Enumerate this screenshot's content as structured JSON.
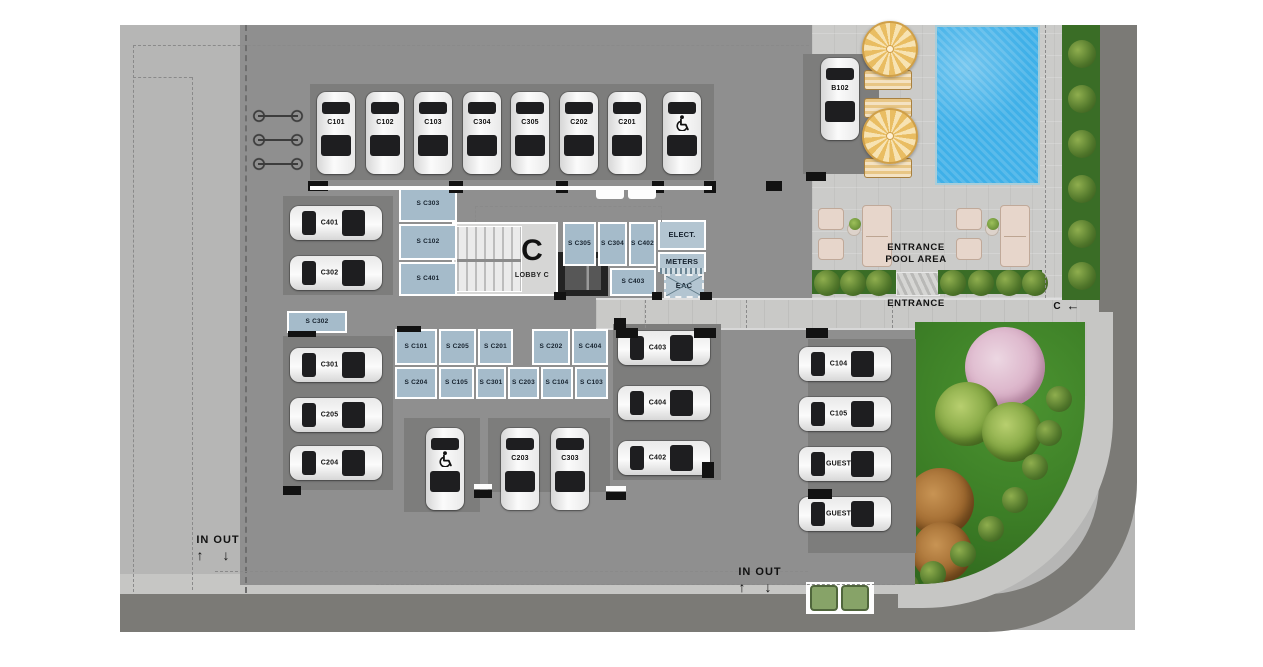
{
  "meta": {
    "type": "parking-site-plan",
    "building_letter": "C"
  },
  "colors": {
    "apron": "#b6b6b5",
    "garage_slab": "#8f8f8f",
    "parking_zone": "#7d7d7c",
    "storage_room": "#a5bbca",
    "pool_water": "#3fb0e8",
    "lawn": "#3c7e26",
    "road": "#7b7a76",
    "sidewalk": "#c6c6c4",
    "umbrella": "#e9bd62",
    "hedge": "#3a6d26"
  },
  "lobby": {
    "letter": "C",
    "label": "LOBBY C"
  },
  "zones": [
    {
      "x": 310,
      "y": 84,
      "w": 350,
      "h": 96
    },
    {
      "x": 659,
      "y": 84,
      "w": 55,
      "h": 96
    },
    {
      "x": 283,
      "y": 196,
      "w": 110,
      "h": 99
    },
    {
      "x": 283,
      "y": 336,
      "w": 110,
      "h": 154
    },
    {
      "x": 404,
      "y": 418,
      "w": 76,
      "h": 94
    },
    {
      "x": 488,
      "y": 418,
      "w": 122,
      "h": 74
    },
    {
      "x": 613,
      "y": 324,
      "w": 108,
      "h": 156
    },
    {
      "x": 803,
      "y": 54,
      "w": 76,
      "h": 120
    },
    {
      "x": 808,
      "y": 339,
      "w": 108,
      "h": 214
    }
  ],
  "cars": [
    {
      "label": "C101",
      "x": 317,
      "y": 92,
      "o": "v"
    },
    {
      "label": "C102",
      "x": 366,
      "y": 92,
      "o": "v"
    },
    {
      "label": "C103",
      "x": 414,
      "y": 92,
      "o": "v"
    },
    {
      "label": "C304",
      "x": 463,
      "y": 92,
      "o": "v"
    },
    {
      "label": "C305",
      "x": 511,
      "y": 92,
      "o": "v"
    },
    {
      "label": "C202",
      "x": 560,
      "y": 92,
      "o": "v"
    },
    {
      "label": "C201",
      "x": 608,
      "y": 92,
      "o": "v"
    },
    {
      "label": "",
      "x": 663,
      "y": 92,
      "o": "v",
      "hc": true
    },
    {
      "label": "C401",
      "x": 290,
      "y": 206,
      "o": "h"
    },
    {
      "label": "C302",
      "x": 290,
      "y": 256,
      "o": "h"
    },
    {
      "label": "C301",
      "x": 290,
      "y": 348,
      "o": "h"
    },
    {
      "label": "C205",
      "x": 290,
      "y": 398,
      "o": "h"
    },
    {
      "label": "C204",
      "x": 290,
      "y": 446,
      "o": "h"
    },
    {
      "label": "",
      "x": 426,
      "y": 428,
      "o": "v",
      "hc": true
    },
    {
      "label": "C203",
      "x": 501,
      "y": 428,
      "o": "v"
    },
    {
      "label": "C303",
      "x": 551,
      "y": 428,
      "o": "v"
    },
    {
      "label": "C403",
      "x": 618,
      "y": 331,
      "o": "h"
    },
    {
      "label": "C404",
      "x": 618,
      "y": 386,
      "o": "h"
    },
    {
      "label": "C402",
      "x": 618,
      "y": 441,
      "o": "h"
    },
    {
      "label": "B102",
      "x": 821,
      "y": 58,
      "o": "v"
    },
    {
      "label": "C104",
      "x": 799,
      "y": 347,
      "o": "h"
    },
    {
      "label": "C105",
      "x": 799,
      "y": 397,
      "o": "h"
    },
    {
      "label": "GUEST",
      "x": 799,
      "y": 447,
      "o": "h"
    },
    {
      "label": "GUEST",
      "x": 799,
      "y": 497,
      "o": "h"
    }
  ],
  "storage": [
    {
      "label": "S C303",
      "x": 399,
      "y": 186,
      "w": 58,
      "h": 36
    },
    {
      "label": "S C102",
      "x": 399,
      "y": 224,
      "w": 58,
      "h": 36
    },
    {
      "label": "S C401",
      "x": 399,
      "y": 262,
      "w": 58,
      "h": 34
    },
    {
      "label": "S C305",
      "x": 563,
      "y": 222,
      "w": 33,
      "h": 44
    },
    {
      "label": "S C304",
      "x": 598,
      "y": 222,
      "w": 29,
      "h": 44
    },
    {
      "label": "S C402",
      "x": 629,
      "y": 222,
      "w": 27,
      "h": 44
    },
    {
      "label": "S C403",
      "x": 610,
      "y": 268,
      "w": 46,
      "h": 28
    },
    {
      "label": "S C302",
      "x": 287,
      "y": 311,
      "w": 60,
      "h": 22
    },
    {
      "label": "S C101",
      "x": 395,
      "y": 329,
      "w": 42,
      "h": 36
    },
    {
      "label": "S C205",
      "x": 439,
      "y": 329,
      "w": 37,
      "h": 36
    },
    {
      "label": "S C201",
      "x": 478,
      "y": 329,
      "w": 35,
      "h": 36
    },
    {
      "label": "S C202",
      "x": 532,
      "y": 329,
      "w": 38,
      "h": 36
    },
    {
      "label": "S C404",
      "x": 572,
      "y": 329,
      "w": 36,
      "h": 36
    },
    {
      "label": "S C204",
      "x": 395,
      "y": 367,
      "w": 42,
      "h": 32
    },
    {
      "label": "S C105",
      "x": 439,
      "y": 367,
      "w": 35,
      "h": 32
    },
    {
      "label": "S C301",
      "x": 476,
      "y": 367,
      "w": 30,
      "h": 32
    },
    {
      "label": "S C203",
      "x": 508,
      "y": 367,
      "w": 31,
      "h": 32
    },
    {
      "label": "S C104",
      "x": 541,
      "y": 367,
      "w": 32,
      "h": 32
    },
    {
      "label": "S C103",
      "x": 575,
      "y": 367,
      "w": 33,
      "h": 32
    }
  ],
  "utility": [
    {
      "label": "ELECT.",
      "x": 658,
      "y": 220,
      "w": 48,
      "h": 30
    },
    {
      "label": "METERS",
      "x": 658,
      "y": 252,
      "w": 48,
      "h": 20
    },
    {
      "label": "EAC",
      "x": 664,
      "y": 274,
      "w": 40,
      "h": 24,
      "cross": true,
      "dashed": true
    }
  ],
  "texts": [
    {
      "t": "ENTRANCE",
      "x": 866,
      "y": 243,
      "w": 100,
      "fs": 9.5,
      "ls": 0.6
    },
    {
      "t": "POOL AREA",
      "x": 866,
      "y": 255,
      "w": 100,
      "fs": 9.5,
      "ls": 0.6
    },
    {
      "t": "ENTRANCE",
      "x": 870,
      "y": 299,
      "w": 92,
      "fs": 9.5,
      "ls": 0.6
    },
    {
      "t": "IN OUT",
      "x": 186,
      "y": 534,
      "w": 64,
      "fs": 11,
      "ls": 1
    },
    {
      "t": "↑",
      "x": 190,
      "y": 547,
      "w": 20,
      "fs": 14,
      "ls": 0
    },
    {
      "t": "↓",
      "x": 216,
      "y": 547,
      "w": 20,
      "fs": 14,
      "ls": 0
    },
    {
      "t": "IN OUT",
      "x": 728,
      "y": 566,
      "w": 64,
      "fs": 11,
      "ls": 1
    },
    {
      "t": "↑",
      "x": 732,
      "y": 579,
      "w": 20,
      "fs": 14,
      "ls": 0
    },
    {
      "t": "↓",
      "x": 758,
      "y": 579,
      "w": 20,
      "fs": 14,
      "ls": 0
    },
    {
      "t": "C",
      "x": 1050,
      "y": 301,
      "w": 14,
      "fs": 10,
      "ls": 0
    },
    {
      "t": "←",
      "x": 1062,
      "y": 299,
      "w": 22,
      "fs": 13,
      "ls": 0
    }
  ],
  "columns": [
    {
      "x": 308,
      "y": 181,
      "w": 20,
      "h": 10
    },
    {
      "x": 449,
      "y": 181,
      "w": 14,
      "h": 12
    },
    {
      "x": 556,
      "y": 181,
      "w": 12,
      "h": 12
    },
    {
      "x": 652,
      "y": 181,
      "w": 12,
      "h": 12
    },
    {
      "x": 704,
      "y": 181,
      "w": 12,
      "h": 12
    },
    {
      "x": 766,
      "y": 181,
      "w": 16,
      "h": 10
    },
    {
      "x": 554,
      "y": 292,
      "w": 12,
      "h": 8
    },
    {
      "x": 652,
      "y": 292,
      "w": 10,
      "h": 8
    },
    {
      "x": 700,
      "y": 292,
      "w": 12,
      "h": 8
    },
    {
      "x": 616,
      "y": 328,
      "w": 22,
      "h": 10
    },
    {
      "x": 694,
      "y": 328,
      "w": 22,
      "h": 10
    },
    {
      "x": 806,
      "y": 328,
      "w": 22,
      "h": 10
    },
    {
      "x": 614,
      "y": 318,
      "w": 12,
      "h": 12
    },
    {
      "x": 702,
      "y": 462,
      "w": 12,
      "h": 16
    },
    {
      "x": 806,
      "y": 172,
      "w": 20,
      "h": 9
    },
    {
      "x": 397,
      "y": 326,
      "w": 24,
      "h": 6
    },
    {
      "x": 288,
      "y": 331,
      "w": 28,
      "h": 6
    },
    {
      "x": 283,
      "y": 486,
      "w": 18,
      "h": 9
    },
    {
      "x": 474,
      "y": 490,
      "w": 18,
      "h": 8
    },
    {
      "x": 606,
      "y": 492,
      "w": 20,
      "h": 8
    },
    {
      "x": 808,
      "y": 489,
      "w": 24,
      "h": 10
    }
  ],
  "curbs": [
    {
      "x": 310,
      "y": 186,
      "w": 402,
      "h": 4
    },
    {
      "x": 474,
      "y": 484,
      "w": 18,
      "h": 5
    },
    {
      "x": 606,
      "y": 486,
      "w": 20,
      "h": 5
    },
    {
      "x": 596,
      "y": 187,
      "w": 28,
      "h": 12,
      "r": 3
    },
    {
      "x": 628,
      "y": 187,
      "w": 28,
      "h": 12,
      "r": 3
    }
  ],
  "dashes": [
    {
      "o": "v",
      "x": 133,
      "y": 45,
      "l": 547
    },
    {
      "o": "v",
      "x": 192,
      "y": 77,
      "l": 513
    },
    {
      "o": "h",
      "x": 133,
      "y": 45,
      "l": 676
    },
    {
      "o": "h",
      "x": 133,
      "y": 77,
      "l": 59
    },
    {
      "o": "v",
      "x": 245,
      "y": 25,
      "l": 568,
      "b": true
    },
    {
      "o": "h",
      "x": 215,
      "y": 571,
      "l": 593
    },
    {
      "o": "h",
      "x": 376,
      "y": 584,
      "l": 524
    },
    {
      "o": "v",
      "x": 645,
      "y": 300,
      "l": 28
    },
    {
      "o": "v",
      "x": 746,
      "y": 300,
      "l": 28
    },
    {
      "o": "v",
      "x": 892,
      "y": 300,
      "l": 28
    },
    {
      "o": "v",
      "x": 1045,
      "y": 25,
      "l": 273
    },
    {
      "o": "h",
      "x": 475,
      "y": 206,
      "l": 186
    },
    {
      "o": "v",
      "x": 475,
      "y": 206,
      "l": 16
    },
    {
      "o": "v",
      "x": 661,
      "y": 206,
      "l": 16
    }
  ],
  "deck": {
    "umbrellas": [
      {
        "x": 862,
        "y": 21,
        "s": 52
      },
      {
        "x": 862,
        "y": 108,
        "s": 52
      }
    ],
    "lounges": [
      {
        "x": 864,
        "y": 70,
        "w": 48,
        "h": 20
      },
      {
        "x": 864,
        "y": 98,
        "w": 48,
        "h": 20
      },
      {
        "x": 864,
        "y": 158,
        "w": 48,
        "h": 20
      }
    ],
    "seats": [
      {
        "x": 818,
        "y": 208,
        "w": 26,
        "h": 22
      },
      {
        "x": 818,
        "y": 238,
        "w": 26,
        "h": 22
      },
      {
        "x": 862,
        "y": 205,
        "w": 30,
        "h": 62,
        "sofa": true
      },
      {
        "x": 956,
        "y": 208,
        "w": 26,
        "h": 22
      },
      {
        "x": 956,
        "y": 238,
        "w": 26,
        "h": 22
      },
      {
        "x": 1000,
        "y": 205,
        "w": 30,
        "h": 62,
        "sofa": true
      }
    ],
    "tables": [
      {
        "x": 847,
        "y": 222,
        "s": 14
      },
      {
        "x": 985,
        "y": 222,
        "s": 14
      }
    ],
    "plants": [
      {
        "x": 849,
        "y": 218,
        "s": 12
      },
      {
        "x": 987,
        "y": 218,
        "s": 12
      }
    ]
  },
  "landscape": {
    "hedge_strips": [
      {
        "x": 812,
        "y": 270,
        "w": 84,
        "h": 24
      },
      {
        "x": 938,
        "y": 270,
        "w": 104,
        "h": 24
      }
    ],
    "hedge_bushes": [
      {
        "x": 814,
        "y": 270,
        "s": 26
      },
      {
        "x": 840,
        "y": 270,
        "s": 26
      },
      {
        "x": 866,
        "y": 270,
        "s": 26
      },
      {
        "x": 940,
        "y": 270,
        "s": 26
      },
      {
        "x": 968,
        "y": 270,
        "s": 26
      },
      {
        "x": 996,
        "y": 270,
        "s": 26
      },
      {
        "x": 1022,
        "y": 270,
        "s": 26
      },
      {
        "x": 1068,
        "y": 40,
        "s": 28
      },
      {
        "x": 1068,
        "y": 85,
        "s": 28
      },
      {
        "x": 1068,
        "y": 130,
        "s": 28
      },
      {
        "x": 1068,
        "y": 175,
        "s": 28
      },
      {
        "x": 1068,
        "y": 220,
        "s": 28
      },
      {
        "x": 1068,
        "y": 262,
        "s": 28
      }
    ],
    "lawn_trees": [
      {
        "type": "pink",
        "x": 50,
        "y": 5,
        "s": 80
      },
      {
        "type": "green",
        "x": 20,
        "y": 60,
        "s": 64
      },
      {
        "type": "green",
        "x": 67,
        "y": 80,
        "s": 60
      },
      {
        "type": "brown",
        "x": -9,
        "y": 146,
        "s": 68
      },
      {
        "type": "brown",
        "x": -3,
        "y": 200,
        "s": 60
      }
    ],
    "lawn_bushes": [
      {
        "x": 131,
        "y": 64,
        "s": 26
      },
      {
        "x": 121,
        "y": 98,
        "s": 26
      },
      {
        "x": 107,
        "y": 132,
        "s": 26
      },
      {
        "x": 87,
        "y": 165,
        "s": 26
      },
      {
        "x": 63,
        "y": 194,
        "s": 26
      },
      {
        "x": 35,
        "y": 219,
        "s": 26
      },
      {
        "x": 5,
        "y": 239,
        "s": 26
      },
      {
        "x": -22,
        "y": 251,
        "s": 26
      }
    ],
    "bins": {
      "frame": {
        "x": 806,
        "y": 582,
        "w": 68,
        "h": 32
      },
      "items": [
        {
          "x": 810,
          "y": 585,
          "w": 28,
          "h": 26
        },
        {
          "x": 841,
          "y": 585,
          "w": 28,
          "h": 26
        }
      ]
    }
  },
  "bikes": [
    {
      "x": 250,
      "y": 108
    },
    {
      "x": 250,
      "y": 132
    },
    {
      "x": 250,
      "y": 156
    }
  ]
}
